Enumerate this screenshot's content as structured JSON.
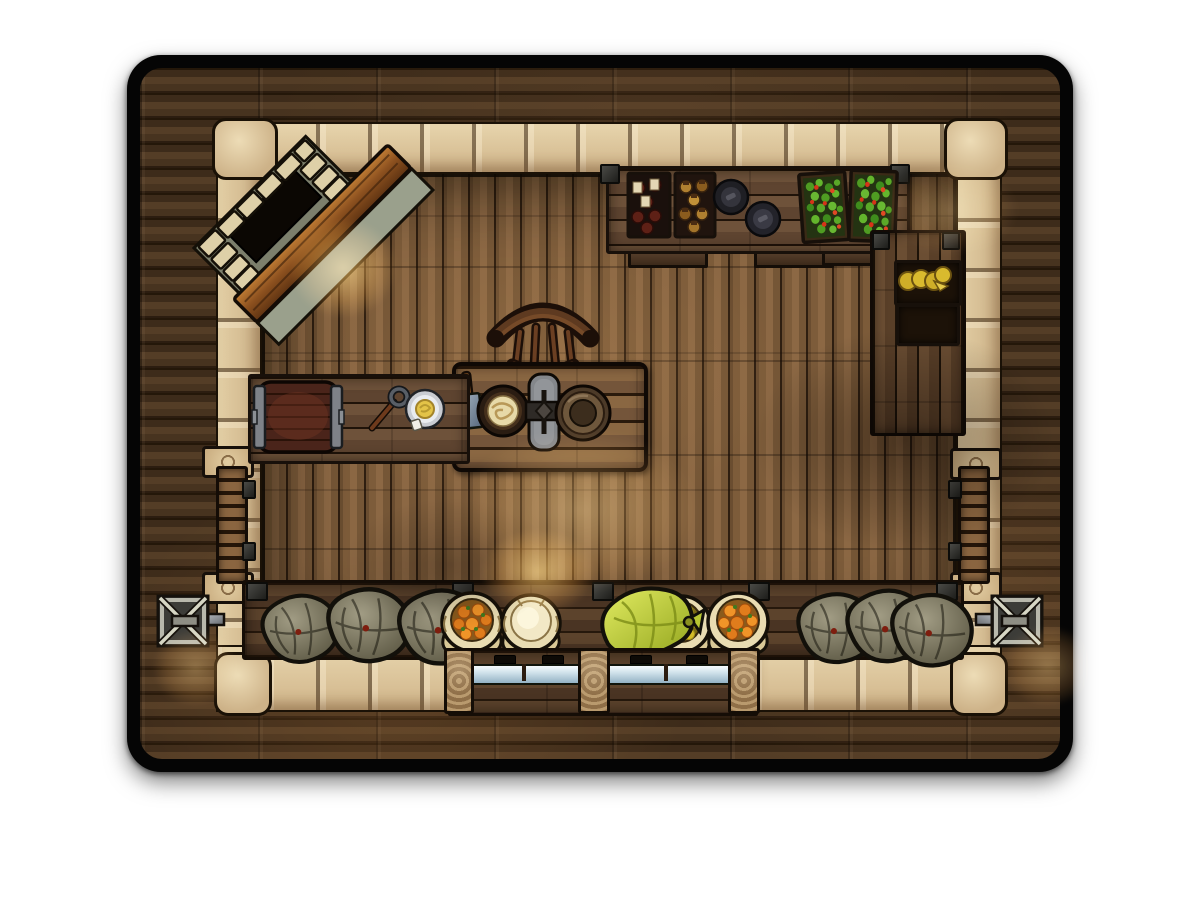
{
  "page": {
    "background": "#ffffff"
  },
  "map": {
    "label": "Top-down tavern provisions room battle map",
    "style": "hand-drawn fantasy VTT map tile with rounded black frame",
    "room": {
      "walls": "rough beige stone blocks",
      "floor": "vertical wood planks",
      "exterior": "dark horizontal wood planks"
    }
  },
  "palette": {
    "page_bg": "#ffffff",
    "ink": "#140d07",
    "card_frame": "#050505",
    "wood_ext_mid": "#47331f",
    "floor_mid": "#7d5c3a",
    "stone_light": "#e8d6ae",
    "stone_mid": "#cfb388",
    "table_wood": "#8a6742",
    "barrel_wood": "#5c2d1f",
    "metal_dark": "#24242a",
    "metal_light": "#8f9398",
    "sack_grey": "#8f8a72",
    "sack_cream": "#e9dcb2",
    "sack_lime": "#c9d93f",
    "orange_fruit": "#e07c1c",
    "lemon_fruit": "#e2cf3c",
    "flour": "#f2e8c6",
    "leaf_green": "#4f9c22",
    "tomato_red": "#d63418",
    "wine_bottle": "#5e241a",
    "amber_jar": "#b08030",
    "cheese": "#d9ba2e",
    "glass": "#cfe1ea",
    "glow_warm": "#ffc464"
  },
  "objects": {
    "map_card": {
      "label": "Battle map tile"
    },
    "staircase": {
      "label": "Diagonal staircase going down, top-left corner"
    },
    "stair_glow": {
      "label": "Warm lantern glow by staircase"
    },
    "top_shelf": {
      "label": "Goods counter along top wall"
    },
    "wine_crate": {
      "label": "Crate of wine bottles"
    },
    "jar_crate": {
      "label": "Crate of preserve jars"
    },
    "pan_1": {
      "label": "Cast-iron pan"
    },
    "pan_2": {
      "label": "Cast-iron pan"
    },
    "produce_crate_1": {
      "label": "Crate of greens and tomatoes"
    },
    "produce_crate_2": {
      "label": "Crate of greens and tomatoes"
    },
    "right_cabinet": {
      "label": "Tall wall cabinet, right side"
    },
    "cheese_shelf": {
      "label": "Shelf with cheese wheels"
    },
    "empty_shelf": {
      "label": "Empty shelf"
    },
    "chair": {
      "label": "Wooden chair"
    },
    "dining_table": {
      "label": "Wooden prep table"
    },
    "cleaver": {
      "label": "Meat cleaver"
    },
    "noodle_bowl": {
      "label": "Bowl of dough/noodles"
    },
    "grinder": {
      "label": "Grinding stone with iron fitting"
    },
    "metal_plate": {
      "label": "Bronze plate"
    },
    "prep_counter": {
      "label": "Prep counter, left wall"
    },
    "barrel": {
      "label": "Barrel lying on its side"
    },
    "ladle": {
      "label": "Long-handled ladle"
    },
    "butter_plate": {
      "label": "Silver plate with butter"
    },
    "left_door": {
      "label": "Plank door in left wall"
    },
    "right_door": {
      "label": "Plank door in right wall"
    },
    "carved_stone": {
      "label": "Carved stone block"
    },
    "bench": {
      "label": "Storage bench along bottom wall"
    },
    "grey_sack": {
      "label": "Closed burlap sack"
    },
    "sack_oranges_1": {
      "label": "Open sack of oranges"
    },
    "sack_flour": {
      "label": "Open sack of flour"
    },
    "sack_tied": {
      "label": "Tied lime-green sack"
    },
    "sack_lemons": {
      "label": "Open sack of lemons"
    },
    "sack_oranges_2": {
      "label": "Open sack of oranges"
    },
    "display_counter": {
      "label": "Glass display counter, shop front"
    },
    "left_sconce": {
      "label": "Metal wall sconce, left"
    },
    "right_sconce": {
      "label": "Metal wall sconce, right"
    },
    "light_glow": {
      "label": "Warm light pool"
    },
    "shadow": {
      "label": "Ambient shadow"
    }
  }
}
